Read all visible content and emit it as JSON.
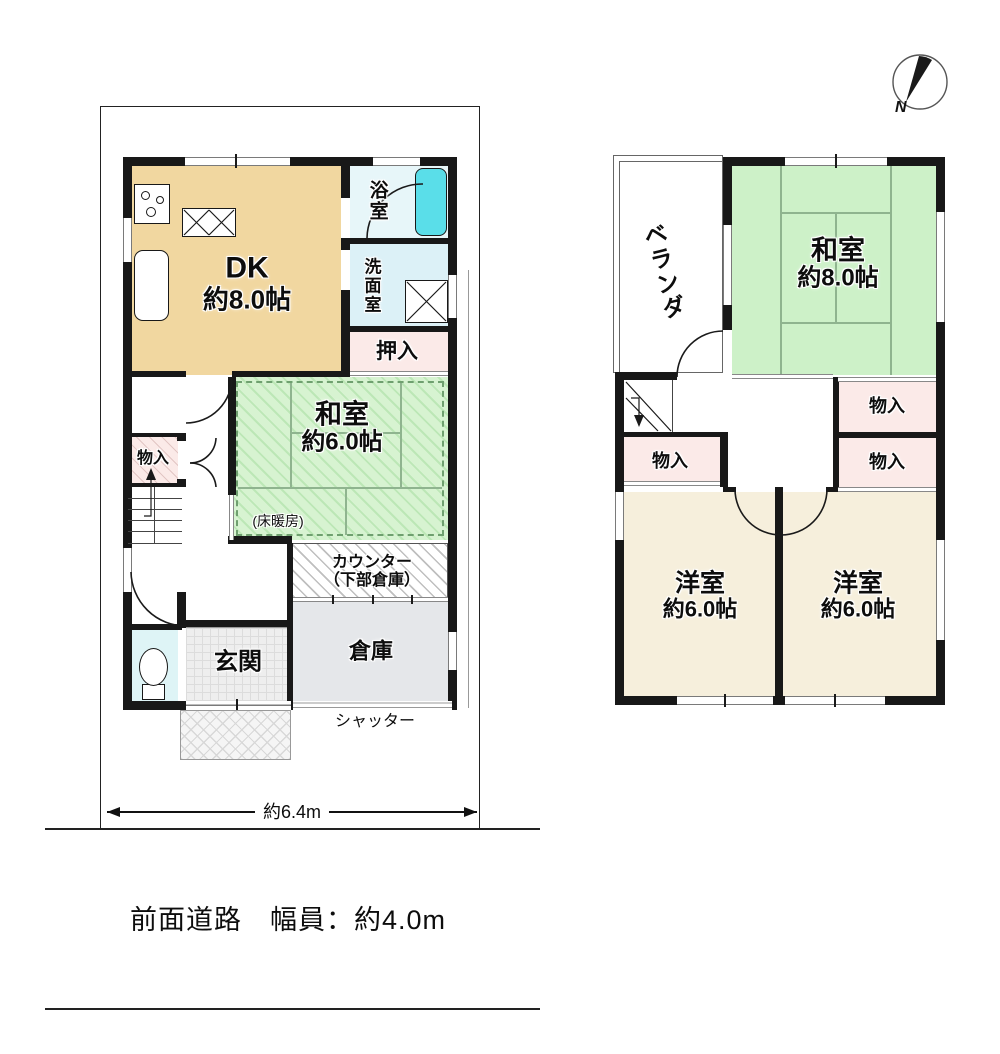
{
  "compass": {
    "north_label": "N"
  },
  "site": {
    "width_dimension": "約6.4m",
    "front_road": "前面道路　幅員：約4.0m"
  },
  "floor1": {
    "dk": {
      "name": "DK",
      "size": "約8.0帖"
    },
    "bath": {
      "label": "浴室"
    },
    "washroom": {
      "label": "洗面室"
    },
    "oshiire": {
      "label": "押入"
    },
    "washitsu": {
      "name": "和室",
      "size": "約6.0帖",
      "note": "(床暖房)"
    },
    "counter": {
      "line1": "カウンター",
      "line2": "（下部倉庫）"
    },
    "storage": {
      "label": "倉庫"
    },
    "genkan": {
      "label": "玄関"
    },
    "closet": {
      "label": "物入"
    },
    "shutter": {
      "label": "シャッター"
    }
  },
  "floor2": {
    "veranda": {
      "label": "ベランダ"
    },
    "washitsu": {
      "name": "和室",
      "size": "約8.0帖"
    },
    "closet_left": {
      "label": "物入"
    },
    "closet_right_upper": {
      "label": "物入"
    },
    "closet_right_lower": {
      "label": "物入"
    },
    "western_left": {
      "name": "洋室",
      "size": "約6.0帖"
    },
    "western_right": {
      "name": "洋室",
      "size": "約6.0帖"
    }
  },
  "colors": {
    "wall": "#181818",
    "dk_tan": "#F1D7A0",
    "tatami_green": "#CDF1C8",
    "western_cream": "#F6EFDC",
    "closet_pink": "#FBEAE8",
    "bath_blue": "#E7F6F9",
    "washroom_blue": "#DCF1F7",
    "toilet_blue": "#DEF4F6",
    "storage_gray": "#E5E7EA",
    "bathtub_cyan": "#5ADEE9"
  }
}
